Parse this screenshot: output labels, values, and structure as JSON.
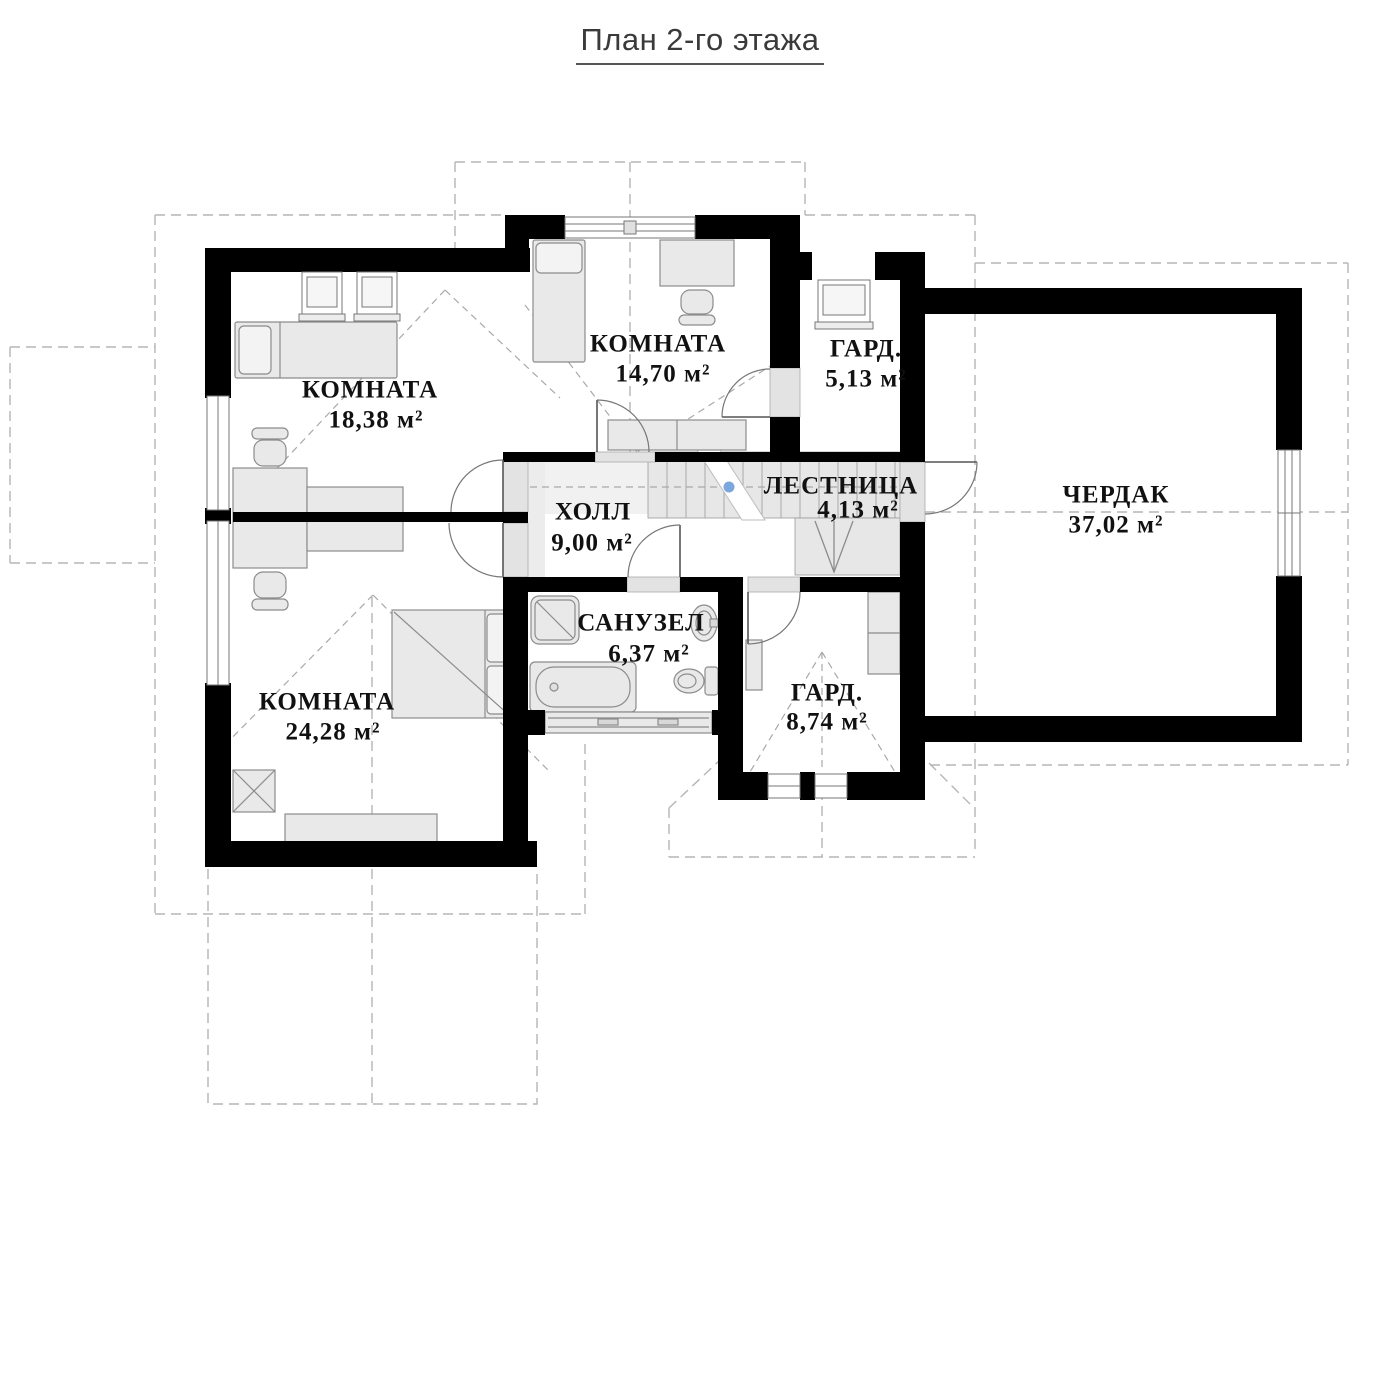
{
  "title": "План 2-го этажа",
  "plan": {
    "rooms": [
      {
        "name": "КОМНАТА",
        "area": "18,38 м²"
      },
      {
        "name": "КОМНАТА",
        "area": "14,70 м²"
      },
      {
        "name": "ГАРД.",
        "area": "5,13 м²"
      },
      {
        "name": "ЧЕРДАК",
        "area": "37,02 м²"
      },
      {
        "name": "ХОЛЛ",
        "area": "9,00 м²"
      },
      {
        "name": "ЛЕСТНИЦА",
        "area": "4,13 м²"
      },
      {
        "name": "САНУЗЕЛ",
        "area": "6,37 м²"
      },
      {
        "name": "КОМНАТА",
        "area": "24,28 м²"
      },
      {
        "name": "ГАРД.",
        "area": "8,74 м²"
      }
    ],
    "colors": {
      "wall": "#000000",
      "furniture_fill": "#e9e9e9",
      "furniture_stroke": "#8c8c8c",
      "floor_gray": "#e7e7e7",
      "dashed_line": "#b5b5b5",
      "stair_marker_blue": "#7ba7dc",
      "label_text": "#111111",
      "title_text": "#3a3a3a"
    }
  }
}
